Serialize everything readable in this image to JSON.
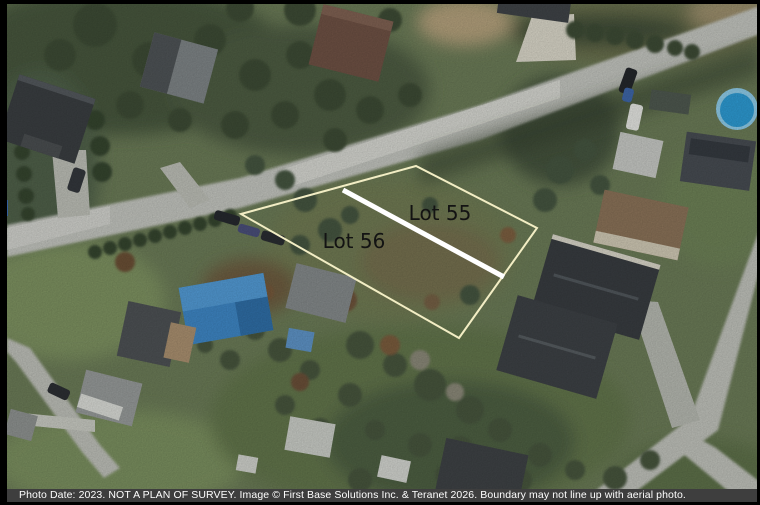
{
  "annotation": {
    "lots": [
      {
        "label": "Lot 55"
      },
      {
        "label": "Lot 56"
      }
    ],
    "boundary_color": "#f2edc4",
    "divider_color": "#ffffff",
    "label_color": "#131313"
  },
  "caption": {
    "text": "Photo Date: 2023. NOT A PLAN OF SURVEY. Image © First Base Solutions Inc. & Teranet 2026. Boundary may not line up with aerial photo.",
    "background": "#3e3e3e",
    "text_color": "#ffffff"
  },
  "colors": {
    "frame": "#000000",
    "grass": "#6b7b57",
    "road": "#c2c4be",
    "pool_water": "#2d9ad2",
    "blue_roof": "#3e86c4",
    "dark_roof": "#383c40"
  }
}
